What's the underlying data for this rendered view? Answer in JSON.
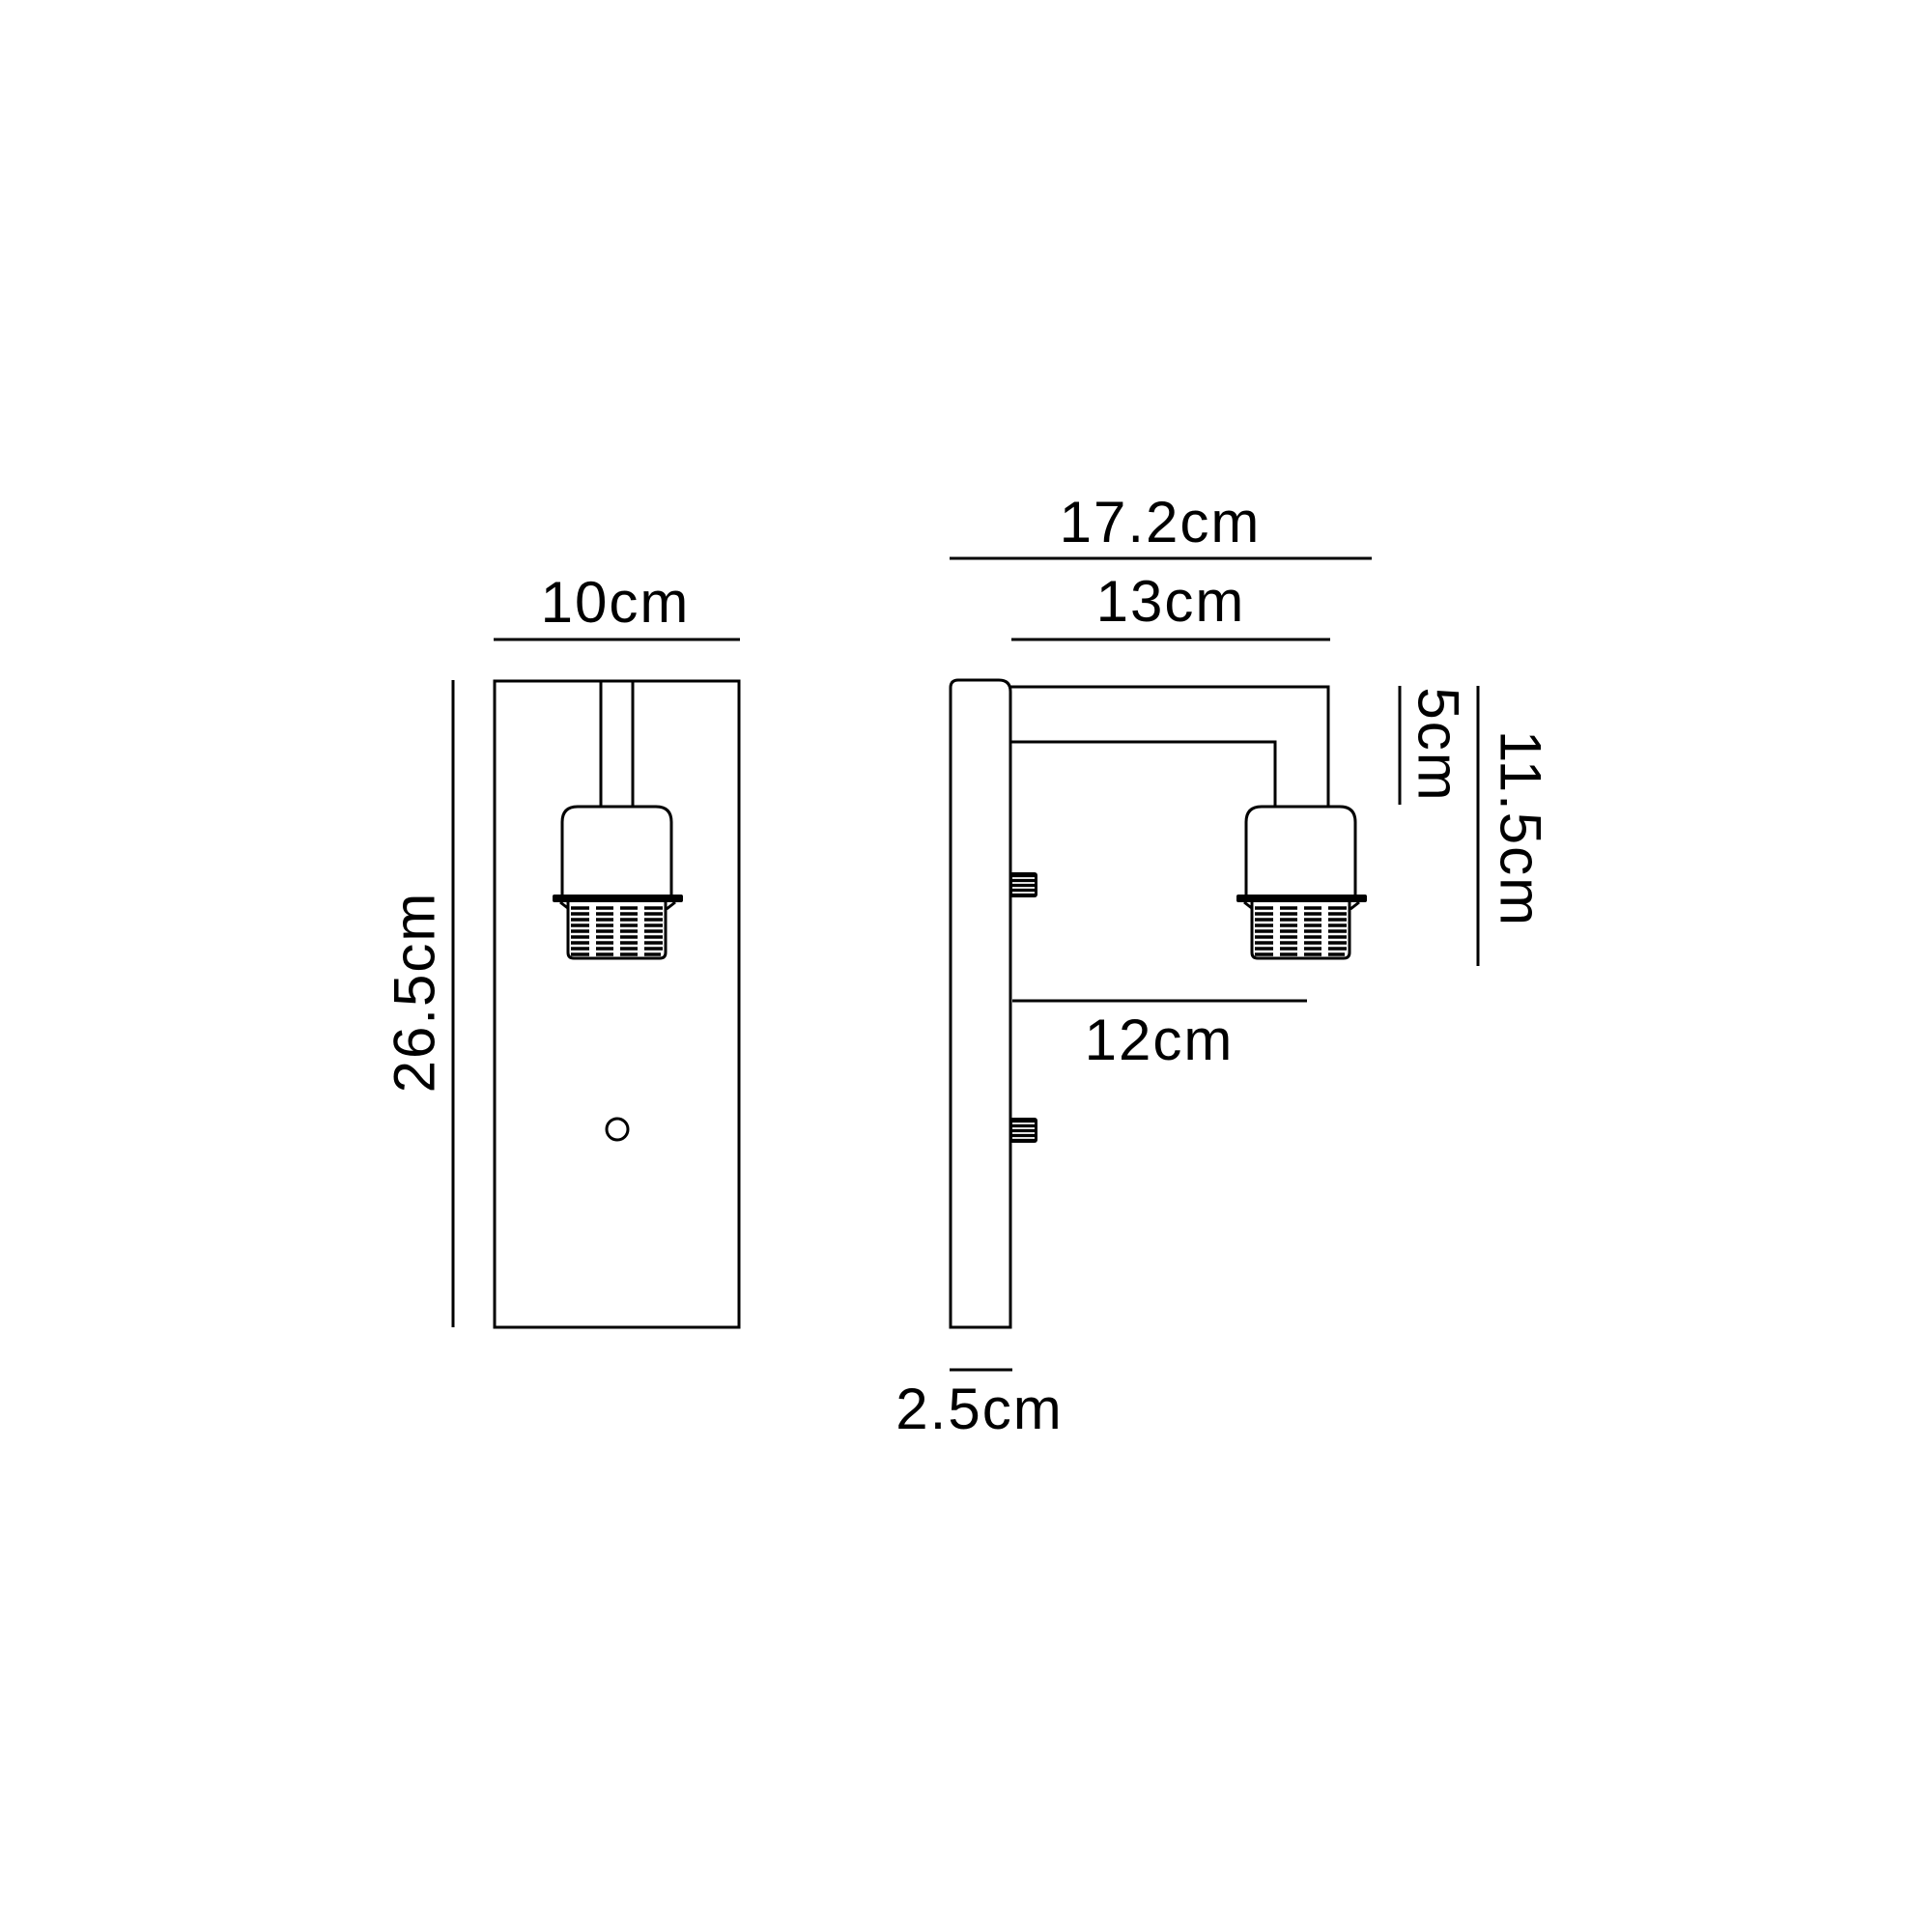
{
  "diagram": {
    "type": "technical-dimension-drawing",
    "subject": "wall-light-fixture",
    "background_color": "#ffffff",
    "line_color": "#000000",
    "views": {
      "front": {
        "width_label": "10cm",
        "height_label": "26.5cm"
      },
      "side": {
        "total_depth_label": "17.2cm",
        "arm_depth_label": "13cm",
        "arm_drop_label": "5cm",
        "holder_drop_label": "11.5cm",
        "clearance_label": "12cm",
        "backplate_depth_label": "2.5cm"
      }
    }
  }
}
